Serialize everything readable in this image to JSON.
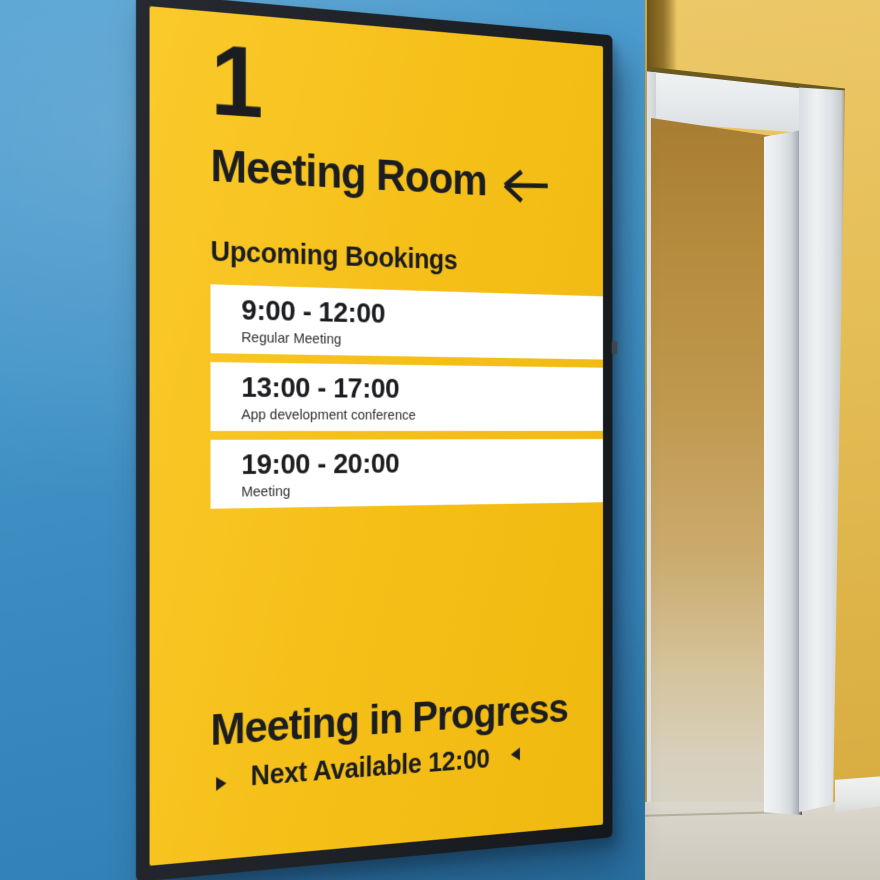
{
  "display": {
    "room_number": "1",
    "room_name": "Meeting Room",
    "upcoming_heading": "Upcoming Bookings",
    "bookings": [
      {
        "time": "9:00 - 12:00",
        "title": "Regular Meeting"
      },
      {
        "time": "13:00 - 17:00",
        "title": "App development conference"
      },
      {
        "time": "19:00 - 20:00",
        "title": "Meeting"
      }
    ],
    "status": "Meeting in Progress",
    "next_available": "Next Available 12:00"
  },
  "icons": {
    "direction_arrow": "left-arrow",
    "next_marker": "right-triangle",
    "prev_marker": "left-triangle"
  },
  "colors": {
    "screen_yellow": "#F6C01A",
    "screen_text": "#1B1D20",
    "card_white": "#FFFFFF",
    "bezel": "#1E2126",
    "wall_blue": "#3E8CC2",
    "wall_yellow": "#E2BB51",
    "door_white": "#E9EBED",
    "interior_tan": "#BD954A",
    "floor": "#D5D1C6"
  }
}
